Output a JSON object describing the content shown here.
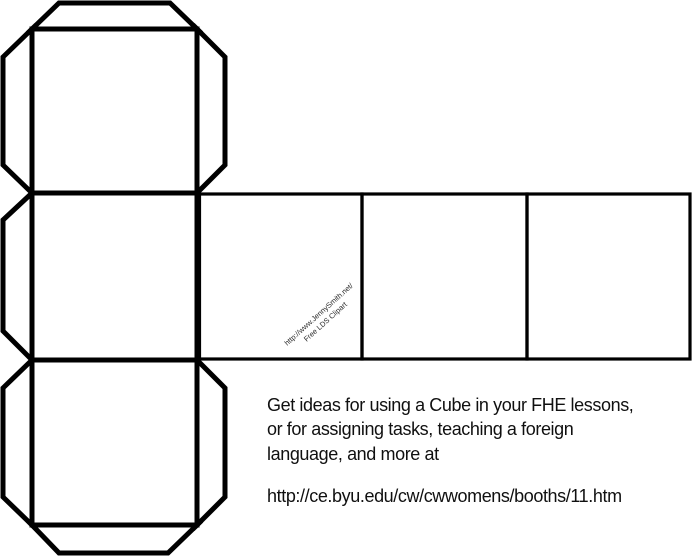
{
  "canvas": {
    "width": 694,
    "height": 557,
    "background": "#ffffff",
    "line_color": "#000000"
  },
  "watermark": {
    "line1": "http://www.JennySmith.net/",
    "line2": "Free LDS Clipart"
  },
  "caption": {
    "line1": "Get ideas for using a Cube in your FHE lessons,",
    "line2": "or for assigning tasks, teaching a foreign",
    "line3": "language, and more at",
    "url": "http://ce.byu.edu/cw/cwwomens/booths/11.htm"
  }
}
